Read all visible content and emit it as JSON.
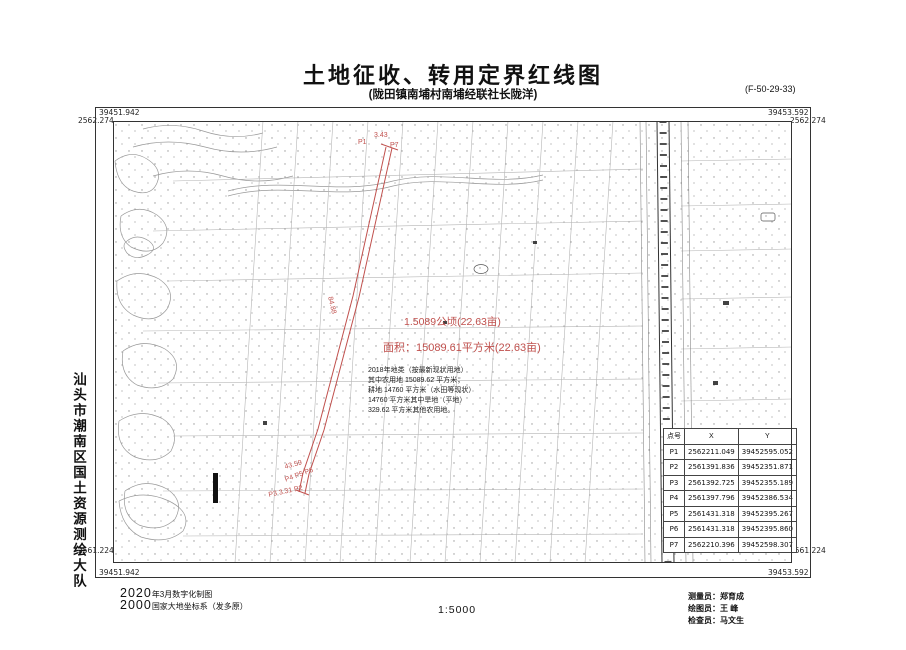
{
  "title": "土地征收、转用定界红线图",
  "subtitle": "(陇田镇南埔村南埔经联社长陇洋)",
  "sheet_number": "(F-50-29-33)",
  "colors": {
    "redline": "#c0504d",
    "ink": "#222222"
  },
  "frame": {
    "tl_x": "39451.942",
    "tl_y": "2562.274",
    "tr_x": "39453.592",
    "tr_y": "2562.274",
    "bl_y": "2561.224",
    "bl_x": "39451.942",
    "br_x": "39453.592",
    "br_y": "2561.224"
  },
  "agency": "汕头市潮南区国土资源测绘大队",
  "red": {
    "area1": "1.5089公顷(22.63亩)",
    "area2": "面积：15089.61平方米(22.63亩)",
    "p1": "P1",
    "d_top": "3.43",
    "p7": "P7",
    "mid": "84.88",
    "b1": "43.59",
    "b2": "P4 P5 P6",
    "b3": "P3 3.31 P2"
  },
  "note": {
    "lines": [
      "2018年地类（按最新现状用地）",
      "其中农用地 15089.62 平方米；",
      "耕地 14760 平方米（水田等现状）",
      "14760 平方米其中旱地（平地）",
      "329.62 平方米其他农用地。"
    ]
  },
  "coord_table": {
    "headers": [
      "点号",
      "X",
      "Y"
    ],
    "rows": [
      [
        "P1",
        "2562211.049",
        "39452595.052"
      ],
      [
        "P2",
        "2561391.836",
        "39452351.871"
      ],
      [
        "P3",
        "2561392.725",
        "39452355.189"
      ],
      [
        "P4",
        "2561397.796",
        "39452386.534"
      ],
      [
        "P5",
        "2561431.318",
        "39452395.267"
      ],
      [
        "P6",
        "2561431.318",
        "39452395.860"
      ],
      [
        "P7",
        "2562210.396",
        "39452598.307"
      ]
    ]
  },
  "footer": {
    "date_big": "2020",
    "date_small": "年3月数字化制图",
    "datum_big": "2000",
    "datum_small": "国家大地坐标系（发多原）",
    "scale": "1:5000",
    "surveyor": "测量员：郑育成",
    "drafter": "绘图员：王 峰",
    "checker": "检查员：马文生"
  }
}
